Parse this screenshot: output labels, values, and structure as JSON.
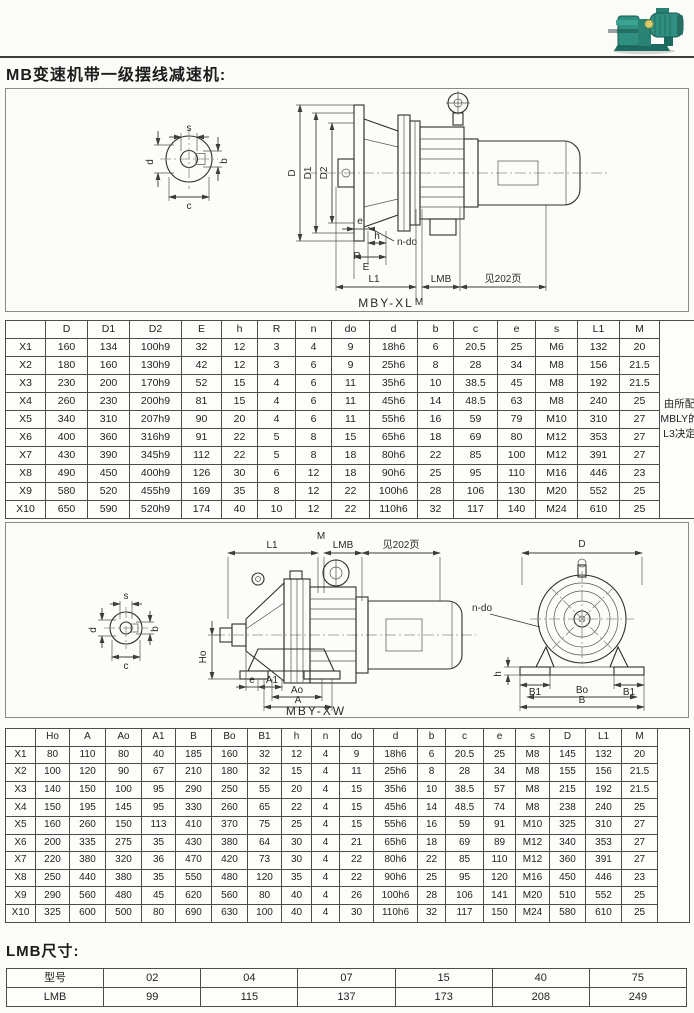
{
  "page": {
    "title": "MB变速机带一级摆线减速机:",
    "lmb_title": "LMB尺寸:"
  },
  "photo": {
    "name": "MB变速机带摆线减速机产品照片",
    "body_color": "#2f8f80",
    "dark_color": "#1d6b60",
    "accent_color": "#d8c96a"
  },
  "diagram1": {
    "caption": "MBY-XL",
    "labels": {
      "s": "s",
      "b": "b",
      "d": "d",
      "c": "c",
      "D": "D",
      "D1": "D1",
      "D2": "D2",
      "n_do": "n-do",
      "e": "e",
      "R": "R",
      "h": "h",
      "E": "E",
      "L1": "L1",
      "M": "M",
      "LMB": "LMB",
      "see": "见202页"
    }
  },
  "diagram2": {
    "caption": "MBY-XW",
    "labels": {
      "L1": "L1",
      "M": "M",
      "LMB": "LMB",
      "see": "见202页",
      "s": "s",
      "b": "b",
      "d": "d",
      "c": "c",
      "Ho": "Ho",
      "e": "e",
      "A1": "A1",
      "Ao": "Ao",
      "A": "A",
      "D": "D",
      "n_do": "n-do",
      "h": "h",
      "B1_left": "B1",
      "B1_right": "B1",
      "Bo": "Bo",
      "B": "B"
    }
  },
  "table1": {
    "headers": [
      "",
      "D",
      "D1",
      "D2",
      "E",
      "h",
      "R",
      "n",
      "do",
      "d",
      "b",
      "c",
      "e",
      "s",
      "L1",
      "M"
    ],
    "note": "由所配MBLY的L3决定",
    "rows": [
      [
        "X1",
        "160",
        "134",
        "100h9",
        "32",
        "12",
        "3",
        "4",
        "9",
        "18h6",
        "6",
        "20.5",
        "25",
        "M6",
        "132",
        "20"
      ],
      [
        "X2",
        "180",
        "160",
        "130h9",
        "42",
        "12",
        "3",
        "6",
        "9",
        "25h6",
        "8",
        "28",
        "34",
        "M8",
        "156",
        "21.5"
      ],
      [
        "X3",
        "230",
        "200",
        "170h9",
        "52",
        "15",
        "4",
        "6",
        "11",
        "35h6",
        "10",
        "38.5",
        "45",
        "M8",
        "192",
        "21.5"
      ],
      [
        "X4",
        "260",
        "230",
        "200h9",
        "81",
        "15",
        "4",
        "6",
        "11",
        "45h6",
        "14",
        "48.5",
        "63",
        "M8",
        "240",
        "25"
      ],
      [
        "X5",
        "340",
        "310",
        "207h9",
        "90",
        "20",
        "4",
        "6",
        "11",
        "55h6",
        "16",
        "59",
        "79",
        "M10",
        "310",
        "27"
      ],
      [
        "X6",
        "400",
        "360",
        "316h9",
        "91",
        "22",
        "5",
        "8",
        "15",
        "65h6",
        "18",
        "69",
        "80",
        "M12",
        "353",
        "27"
      ],
      [
        "X7",
        "430",
        "390",
        "345h9",
        "112",
        "22",
        "5",
        "8",
        "18",
        "80h6",
        "22",
        "85",
        "100",
        "M12",
        "391",
        "27"
      ],
      [
        "X8",
        "490",
        "450",
        "400h9",
        "126",
        "30",
        "6",
        "12",
        "18",
        "90h6",
        "25",
        "95",
        "110",
        "M16",
        "446",
        "23"
      ],
      [
        "X9",
        "580",
        "520",
        "455h9",
        "169",
        "35",
        "8",
        "12",
        "22",
        "100h6",
        "28",
        "106",
        "130",
        "M20",
        "552",
        "25"
      ],
      [
        "X10",
        "650",
        "590",
        "520h9",
        "174",
        "40",
        "10",
        "12",
        "22",
        "110h6",
        "32",
        "117",
        "140",
        "M24",
        "610",
        "25"
      ]
    ]
  },
  "table2": {
    "headers": [
      "",
      "Ho",
      "A",
      "Ao",
      "A1",
      "B",
      "Bo",
      "B1",
      "h",
      "n",
      "do",
      "d",
      "b",
      "c",
      "e",
      "s",
      "D",
      "L1",
      "M"
    ],
    "rows": [
      [
        "X1",
        "80",
        "110",
        "80",
        "40",
        "185",
        "160",
        "32",
        "12",
        "4",
        "9",
        "18h6",
        "6",
        "20.5",
        "25",
        "M8",
        "145",
        "132",
        "20"
      ],
      [
        "X2",
        "100",
        "120",
        "90",
        "67",
        "210",
        "180",
        "32",
        "15",
        "4",
        "11",
        "25h6",
        "8",
        "28",
        "34",
        "M8",
        "155",
        "156",
        "21.5"
      ],
      [
        "X3",
        "140",
        "150",
        "100",
        "95",
        "290",
        "250",
        "55",
        "20",
        "4",
        "15",
        "35h6",
        "10",
        "38.5",
        "57",
        "M8",
        "215",
        "192",
        "21.5"
      ],
      [
        "X4",
        "150",
        "195",
        "145",
        "95",
        "330",
        "260",
        "65",
        "22",
        "4",
        "15",
        "45h6",
        "14",
        "48.5",
        "74",
        "M8",
        "238",
        "240",
        "25"
      ],
      [
        "X5",
        "160",
        "260",
        "150",
        "113",
        "410",
        "370",
        "75",
        "25",
        "4",
        "15",
        "55h6",
        "16",
        "59",
        "91",
        "M10",
        "325",
        "310",
        "27"
      ],
      [
        "X6",
        "200",
        "335",
        "275",
        "35",
        "430",
        "380",
        "64",
        "30",
        "4",
        "21",
        "65h6",
        "18",
        "69",
        "89",
        "M12",
        "340",
        "353",
        "27"
      ],
      [
        "X7",
        "220",
        "380",
        "320",
        "36",
        "470",
        "420",
        "73",
        "30",
        "4",
        "22",
        "80h6",
        "22",
        "85",
        "110",
        "M12",
        "360",
        "391",
        "27"
      ],
      [
        "X8",
        "250",
        "440",
        "380",
        "35",
        "550",
        "480",
        "120",
        "35",
        "4",
        "22",
        "90h6",
        "25",
        "95",
        "120",
        "M16",
        "450",
        "446",
        "23"
      ],
      [
        "X9",
        "290",
        "560",
        "480",
        "45",
        "620",
        "560",
        "80",
        "40",
        "4",
        "26",
        "100h6",
        "28",
        "106",
        "141",
        "M20",
        "510",
        "552",
        "25"
      ],
      [
        "X10",
        "325",
        "600",
        "500",
        "80",
        "690",
        "630",
        "100",
        "40",
        "4",
        "30",
        "110h6",
        "32",
        "117",
        "150",
        "M24",
        "580",
        "610",
        "25"
      ]
    ]
  },
  "lmb_table": {
    "headers": [
      "型号",
      "02",
      "04",
      "07",
      "15",
      "40",
      "75"
    ],
    "rows": [
      [
        "LMB",
        "99",
        "115",
        "137",
        "173",
        "208",
        "249"
      ]
    ]
  }
}
